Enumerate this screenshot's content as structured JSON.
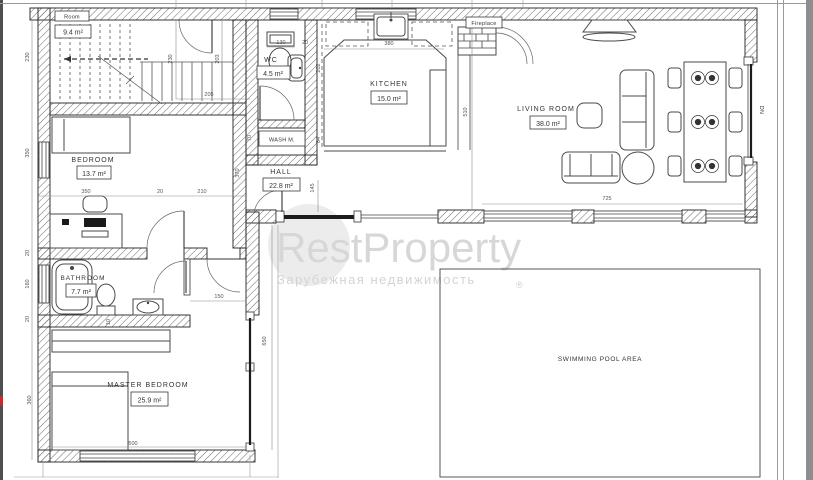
{
  "watermark": {
    "brand": "RestProperty",
    "tagline": "Зарубежная недвижимость",
    "registered": "®"
  },
  "rooms": {
    "stair": {
      "name": "Room",
      "area": "9.4 m²"
    },
    "bedroom": {
      "name": "BEDROOM",
      "area": "13.7 m²"
    },
    "wc": {
      "name": "WC",
      "area": "4.5 m²"
    },
    "wash": {
      "name": "WASH M."
    },
    "kitchen": {
      "name": "KITCHEN",
      "area": "15.0 m²"
    },
    "hall": {
      "name": "HALL",
      "area": "22.8 m²"
    },
    "living": {
      "name": "LIVING ROOM",
      "area": "38.0 m²"
    },
    "bathroom": {
      "name": "BATHROOM",
      "area": "7.7 m²"
    },
    "master": {
      "name": "MASTER BEDROOM",
      "area": "25.9 m²"
    },
    "pool": {
      "name": "SWIMMING POOL AREA"
    }
  },
  "annotations": {
    "fireplace": "Fireplace",
    "down": "DN"
  },
  "dimensions": [
    "230",
    "230",
    "203",
    "205",
    "350",
    "370",
    "350",
    "20",
    "210",
    "130",
    "20",
    "202",
    "84",
    "70",
    "380",
    "145",
    "510",
    "725",
    "20",
    "160",
    "20",
    "150",
    "10",
    "360",
    "500",
    "650"
  ],
  "colors": {
    "line": "#3a3a3a",
    "watermark": "#d7d7d7",
    "accent_red": "#cc2a2a"
  }
}
